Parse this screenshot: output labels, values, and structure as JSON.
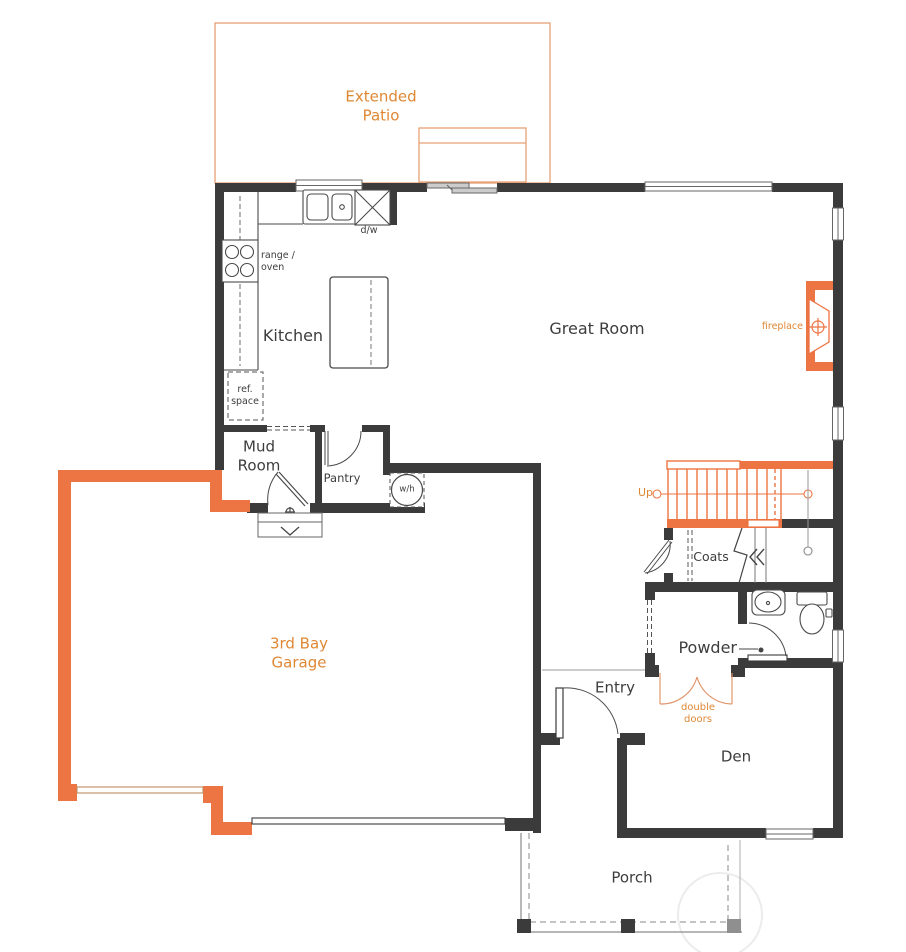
{
  "document": {
    "type": "floor-plan",
    "floor": "main level"
  },
  "colors": {
    "wall": "#3b3b3b",
    "accent_orange": "#ed7443",
    "orange_text": "#de8733",
    "patio_outline": "#e6a176",
    "guide_gray": "#999999"
  },
  "labels": {
    "extended_patio": "Extended Patio",
    "kitchen": "Kitchen",
    "great_room": "Great Room",
    "fireplace": "fireplace",
    "range_oven": "range / oven",
    "dw": "d/w",
    "ref_space": "ref. space",
    "mud_room": "Mud Room",
    "pantry": "Pantry",
    "water_heater": "w/h",
    "up": "Up",
    "coats": "Coats",
    "garage": "3rd Bay Garage",
    "powder": "Powder",
    "entry": "Entry",
    "double_doors": "double doors",
    "den": "Den",
    "porch": "Porch"
  }
}
